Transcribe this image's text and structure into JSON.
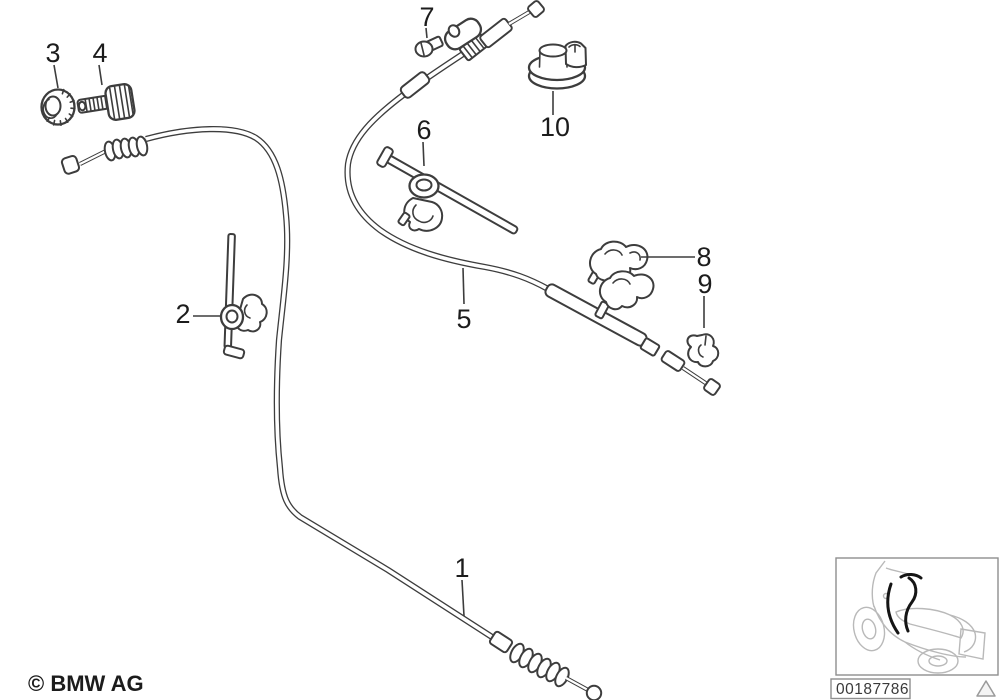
{
  "callouts": [
    {
      "id": 1,
      "label": "1"
    },
    {
      "id": 2,
      "label": "2"
    },
    {
      "id": 3,
      "label": "3"
    },
    {
      "id": 4,
      "label": "4"
    },
    {
      "id": 5,
      "label": "5"
    },
    {
      "id": 6,
      "label": "6"
    },
    {
      "id": 7,
      "label": "7"
    },
    {
      "id": 8,
      "label": "8"
    },
    {
      "id": 9,
      "label": "9"
    },
    {
      "id": 10,
      "label": "10"
    }
  ],
  "copyright": "© BMW AG",
  "thumbnail": {
    "part_number": "00187786"
  },
  "icons": {
    "bottom_right": "warning-triangle-icon"
  },
  "colors": {
    "line": "#3d3d3d",
    "text": "#1c1c1c",
    "frame": "#8f8f8f",
    "thumb-line": "#b9b9b9",
    "thumb-highlight": "#151515"
  }
}
